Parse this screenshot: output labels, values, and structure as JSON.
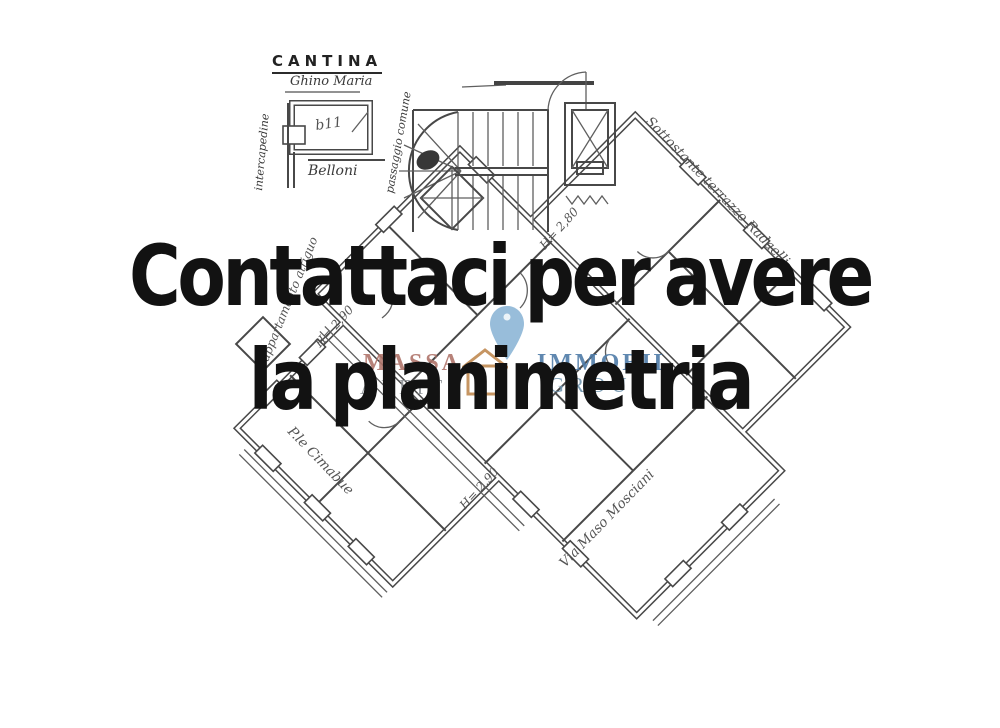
{
  "headline": {
    "line1": "Contattaci per avere",
    "line2": "la planimetria",
    "color": "#121212"
  },
  "watermark": {
    "word_top_left": "MASSA",
    "word_bottom_left": "AFFIT",
    "word_top_right": "IMMOBIL",
    "word_bottom_right": "GROUP",
    "pin_icon": "map-pin-icon",
    "house_icon": "house-icon",
    "colors": {
      "massa": "#b0756b",
      "affit": "#8d9296",
      "immobil": "#4f7ca8",
      "group": "#6e92ab",
      "pin": "#8db6d6",
      "house": "#c08a52"
    }
  },
  "floor_plan": {
    "cantina": {
      "title": "CANTINA",
      "owner": "Ghino Maria",
      "label_left": "intercapedine",
      "label_right": "passaggio comune",
      "name_below": "Belloni",
      "room_code": "b11"
    },
    "heights": [
      {
        "text": "H= 2,90"
      },
      {
        "text": "H= 2,80"
      },
      {
        "text": "H= 2,90"
      }
    ],
    "annotations": {
      "top_right": "Sottostante terrazzo Radaelli",
      "bottom_left": "P.le Cimabue",
      "bottom_right": "Via Maso Mosciani",
      "left_side": "appartamento attiguo"
    },
    "ink_color": "#2f2f2f"
  }
}
